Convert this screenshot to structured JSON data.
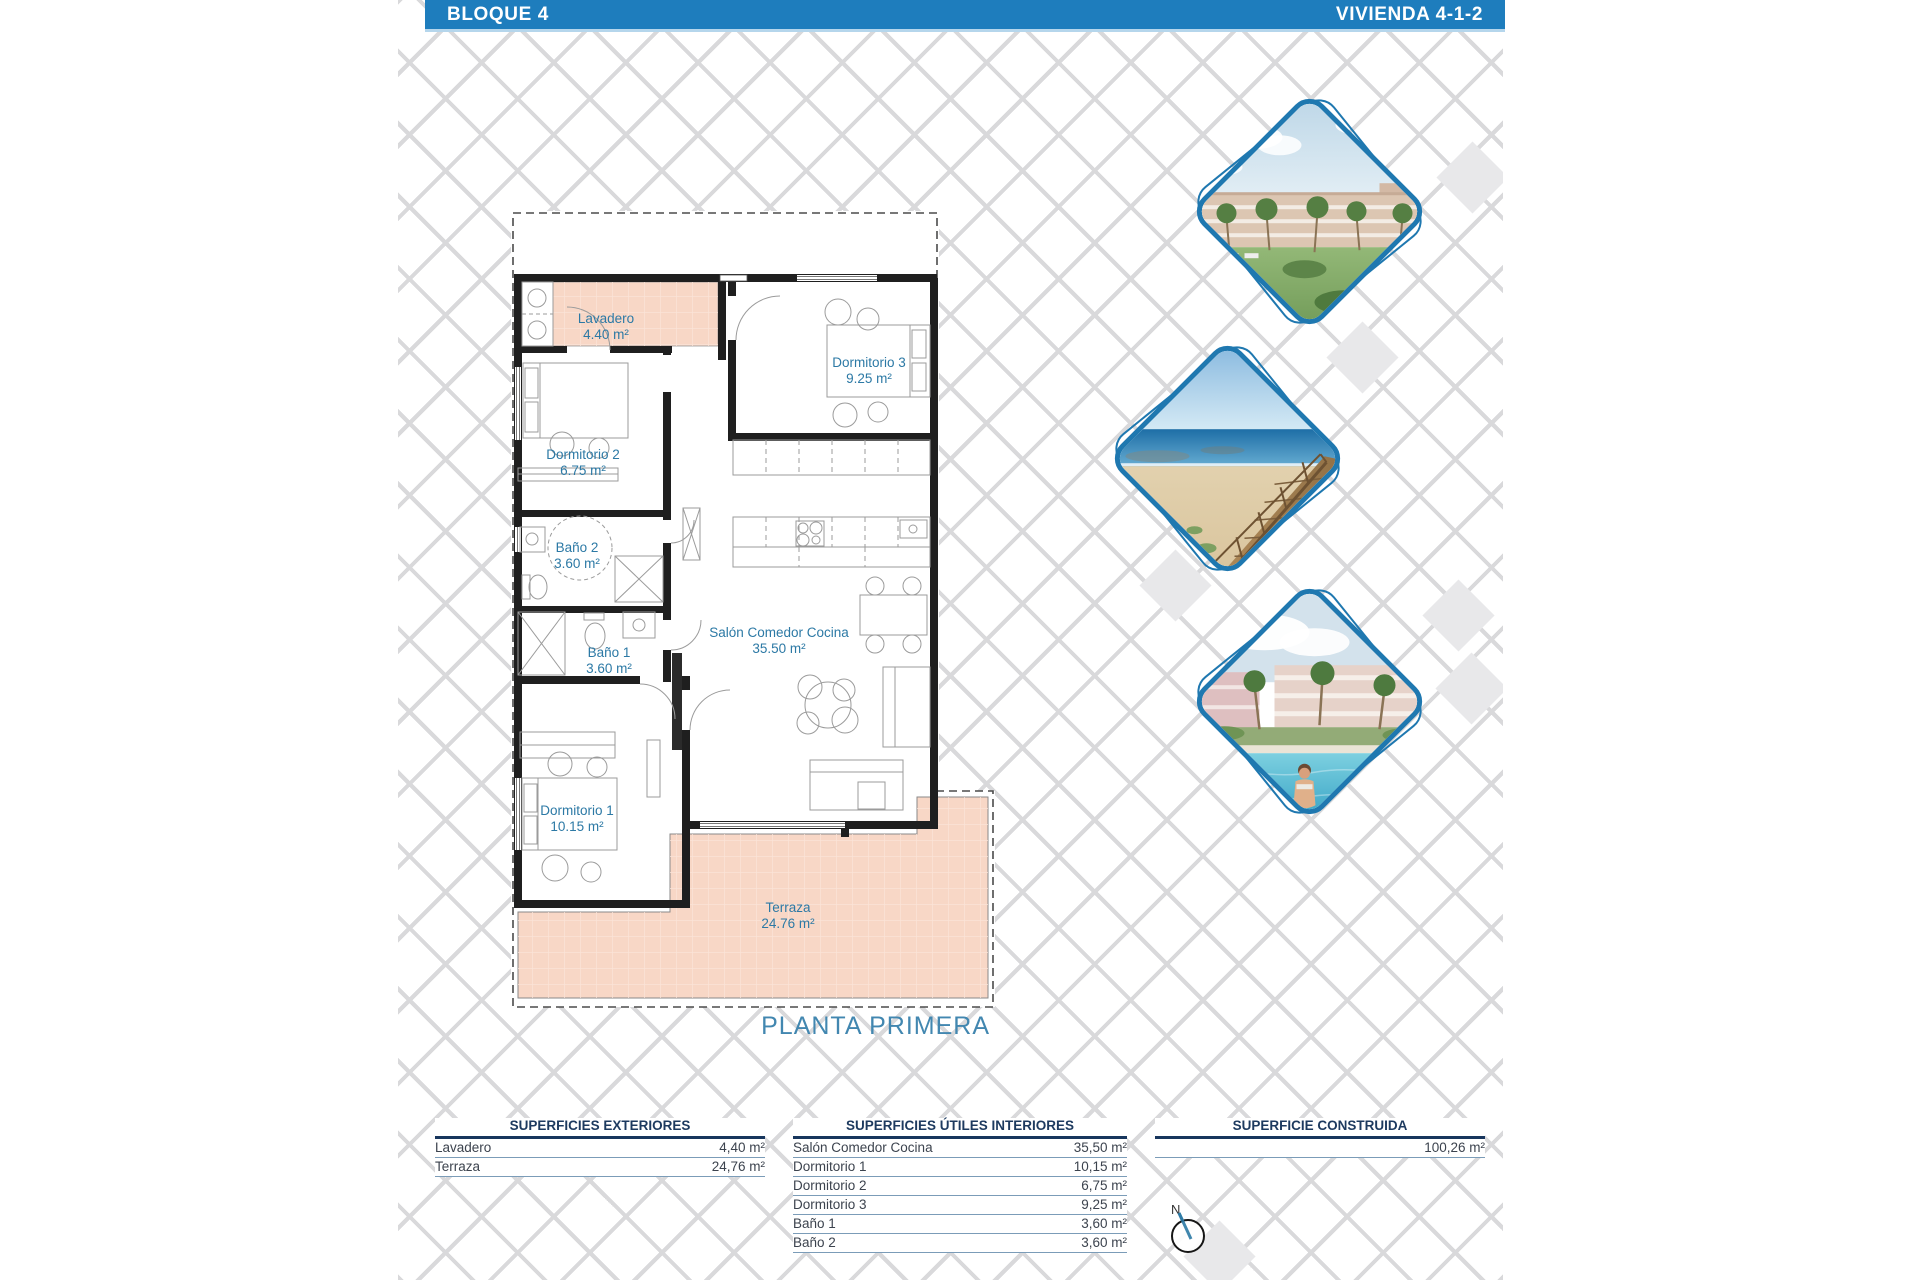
{
  "header": {
    "left_title": "BLOQUE 4",
    "right_title": "VIVIENDA 4-1-2"
  },
  "floorplan": {
    "title": "PLANTA PRIMERA",
    "rooms": {
      "lavadero": {
        "name": "Lavadero",
        "area": "4.40 m²"
      },
      "dormitorio3": {
        "name": "Dormitorio 3",
        "area": "9.25 m²"
      },
      "dormitorio2": {
        "name": "Dormitorio 2",
        "area": "6.75 m²"
      },
      "bano2": {
        "name": "Baño 2",
        "area": "3.60 m²"
      },
      "bano1": {
        "name": "Baño 1",
        "area": "3.60 m²"
      },
      "salon": {
        "name": "Salón Comedor Cocina",
        "area": "35.50 m²"
      },
      "dormitorio1": {
        "name": "Dormitorio 1",
        "area": "10.15 m²"
      },
      "terraza": {
        "name": "Terraza",
        "area": "24.76 m²"
      }
    }
  },
  "tables": {
    "exteriores": {
      "title": "SUPERFICIES EXTERIORES",
      "rows": [
        {
          "label": "Lavadero",
          "value": "4,40 m²"
        },
        {
          "label": "Terraza",
          "value": "24,76 m²"
        }
      ]
    },
    "interiores": {
      "title": "SUPERFICIES ÚTILES INTERIORES",
      "rows": [
        {
          "label": "Salón Comedor Cocina",
          "value": "35,50 m²"
        },
        {
          "label": "Dormitorio 1",
          "value": "10,15 m²"
        },
        {
          "label": "Dormitorio 2",
          "value": "6,75 m²"
        },
        {
          "label": "Dormitorio 3",
          "value": "9,25 m²"
        },
        {
          "label": "Baño 1",
          "value": "3,60 m²"
        },
        {
          "label": "Baño 2",
          "value": "3,60 m²"
        }
      ]
    },
    "construida": {
      "title": "SUPERFICIE CONSTRUIDA",
      "value": "100,26 m²"
    }
  },
  "compass": {
    "north_label": "N"
  },
  "photos": [
    {
      "name": "resort-buildings-palms"
    },
    {
      "name": "beach-boardwalk"
    },
    {
      "name": "pool-and-residences"
    }
  ],
  "colors": {
    "accent_blue": "#1e7dbd",
    "room_label": "#2c79a5",
    "terrace_fill": "#f8d7c6"
  }
}
